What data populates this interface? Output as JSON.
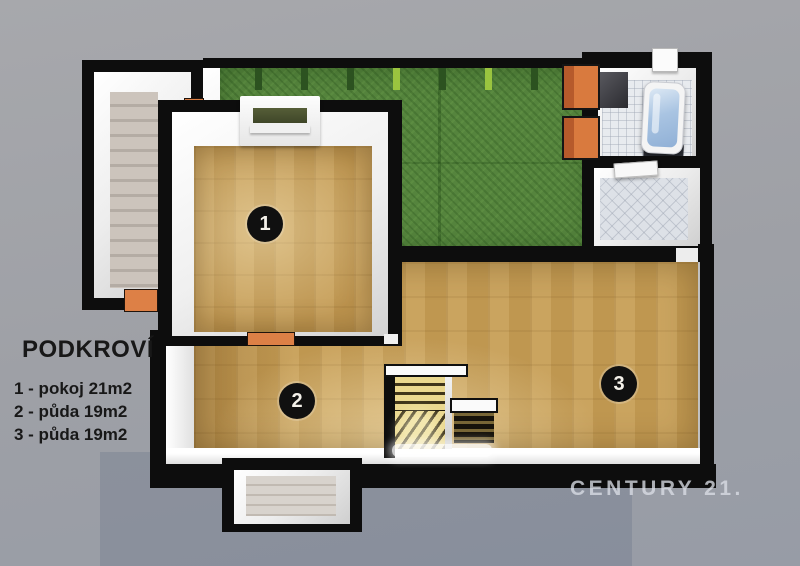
{
  "legend": {
    "title": "PODKROVÍ",
    "items": [
      {
        "label": "1 - pokoj 21m2"
      },
      {
        "label": "2 - půda 19m2"
      },
      {
        "label": "3 - půda 19m2"
      }
    ]
  },
  "markers": {
    "room1": "1",
    "room2": "2",
    "room3": "3"
  },
  "watermark": {
    "brand": "CENTURY 21."
  },
  "colors": {
    "background": "#9ea0a6",
    "wall": "#0d0d0d",
    "wood_floor": "#c79e55",
    "green_carpet": "#55843d",
    "accent_orange": "#d97a3e",
    "tub_water": "#a9c4e2",
    "marker": "#101010"
  }
}
